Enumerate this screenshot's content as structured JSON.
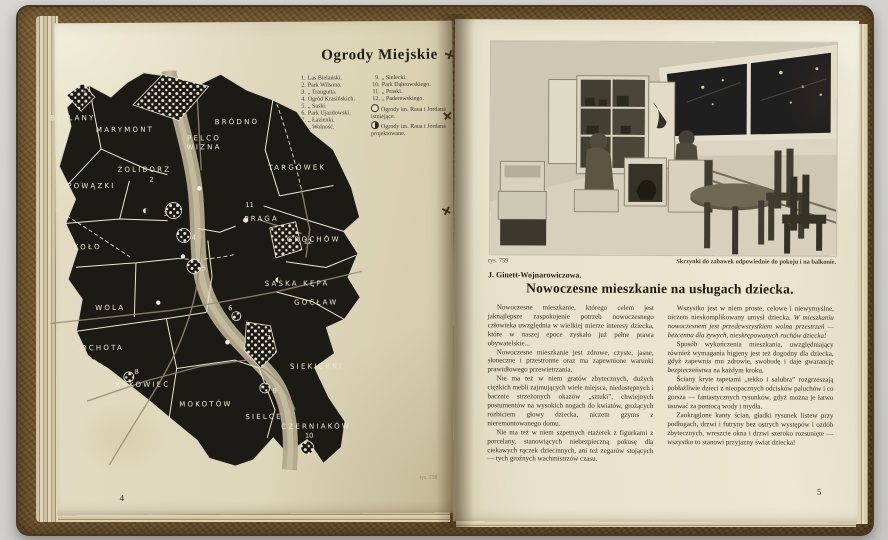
{
  "book": {
    "left_page": {
      "title": "Ogrody Miejskie",
      "legend": {
        "col1": [
          {
            "num": "1.",
            "text": "Las Bielański."
          },
          {
            "num": "2.",
            "text": "Park Wilsona."
          },
          {
            "num": "3.",
            "text": "„  Traugutta."
          },
          {
            "num": "4.",
            "text": "Ogród Krasińskich."
          },
          {
            "num": "5.",
            "text": "„  Saski."
          },
          {
            "num": "6.",
            "text": "Park Ujazdowski."
          },
          {
            "num": "7.",
            "text": "„  Łazienki."
          },
          {
            "num": "8.",
            "text": "„  Wolność."
          }
        ],
        "col2": [
          {
            "num": "9.",
            "text": "„  Sielecki."
          },
          {
            "num": "10.",
            "text": "Park Dąbrowskiego."
          },
          {
            "num": "11.",
            "text": "„  Praski."
          },
          {
            "num": "12.",
            "text": "„  Paderewskiego."
          }
        ],
        "symbols": [
          {
            "text": "Ogrody im. Raua i Jordana istniejące."
          },
          {
            "text": "Ogrody im. Raua i Jordana projektowane."
          }
        ]
      },
      "map_labels": [
        "BIELANY",
        "MARYMONT",
        "BRÓDNO",
        "PELCO",
        "WIZNA",
        "ŻOLIBORZ",
        "POWĄZKI",
        "TARGÓWEK",
        "KOŁO",
        "PRAGA",
        "GROCHÓW",
        "WOLA",
        "SASKA KĘPA",
        "GOCŁAW",
        "OCHOTA",
        "RAKOWIEC",
        "MOKOTÓW",
        "SIELCE",
        "SIEKIERKI",
        "CZERNIAKÓW"
      ],
      "map_numbers": [
        "1",
        "2",
        "3",
        "4",
        "5",
        "6",
        "7",
        "8",
        "9",
        "10",
        "11",
        "12"
      ],
      "figure_ref": "rys. 758",
      "page_number": "4"
    },
    "right_page": {
      "figure_ref": "rys. 759",
      "photo_caption": "Skrzynki do zabawek odpowiednie do pokoju i na balkonie.",
      "article": {
        "author": "J. Ginett-Wojnarowiczowa.",
        "title": "Nowoczesne mieszkanie na usługach dziecka.",
        "col1": [
          "Nowoczesne mieszkanie, którego celem jest jaknajlepsze zaspokojenie potrzeb nowoczesnego człowieka uwzględnia w wielkiej mierze interesy dziecka, które w naszej epoce zyskało już pełne prawa obywatelskie...",
          "Nowoczesne mieszkanie jest zdrowe, czyste, jasne, słoneczne i przestronne oraz ma zapewnione warunki prawidłowego przewietrzania.",
          "Nie ma też w niem gratów zbytecznych, dużych ciężkich mebli zajmujących wiele miejsca, niedostępnych i bacznie strzeżonych okazów „sztuki”, chwiejnych postumentów na wysokich nogach do kwiatów, grożących rozbiciem głowy dziecka, niczem gzyms z nieremontowanego domu.",
          "Nie ma też w niem szpetnych etażerek z figurkami z porcelany, stanowiących niebezpieczną pokusę dla ciekawych rączek dziecinnych, ani też zegarów stojących — tych groźnych wachmistrzów czasu."
        ],
        "col2_intro": "Wszystko jest w niem proste, celowe i niewymyślne, niczem nieskomplikowany umysł dziecka. ",
        "col2_intro_italic": "W mieszkaniu nowoczesnem jest przedewszystkiem wolna przestrzeń — bezcenna dla żywych, nieskrępowanych ruchów dziecka!",
        "col2": [
          "Sposób wykończenia mieszkania, uwzględniający również wymagania higjeny jest też dogodny dla dziecka, gdyż zapewnia mu zdrowie, swobodę i daje gwarancję bezpieczeństwa na każdym kroku.",
          "Ściany kryte tapetami „tekko i salubra” rozgrzeszają pobłażliwie dzieci z nieopacznych odcisków paluchów i co gorsza — fantastycznych rysunków, gdyż można je łatwo usuwać za pomocą wody i mydła.",
          "Zaokrąglone kanty ścian, gładki rysunek listew przy podłogach, drzwi i futryny bez ostrych występów i ozdób zbytecznych, wreszcie okna i drzwi szeroko rozsunięte — wszystko to stanowi przyjazny świat dziecka!"
        ]
      },
      "page_number": "5"
    }
  }
}
